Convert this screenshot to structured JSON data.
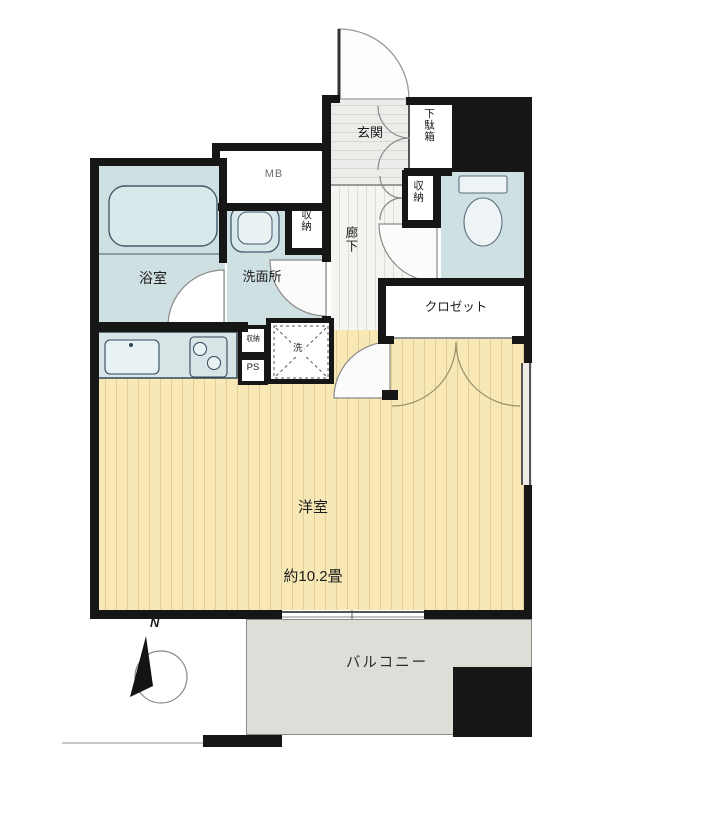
{
  "plan": {
    "entrance_label": "玄関",
    "shoe_cabinet_label": "下駄箱",
    "meter_box_label": "MB",
    "bathroom_label": "浴室",
    "washroom_label": "洗面所",
    "washroom_storage_label": "収納",
    "hallway_label": "廊下",
    "hallway_storage_label": "収納",
    "closet_label": "クロゼット",
    "small_storage_label": "収納",
    "pipe_space_label": "PS",
    "washer_label": "洗",
    "main_room_label": "洋室",
    "main_room_size": "約10.2畳",
    "balcony_label": "バルコニー",
    "compass_label": "N"
  },
  "colors": {
    "wall": "#161616",
    "wet_area": "#cfe0e3",
    "room_floor": "#f7e8b6",
    "hall_floor": "#f4f4f1",
    "balcony": "#dbdfd8"
  }
}
